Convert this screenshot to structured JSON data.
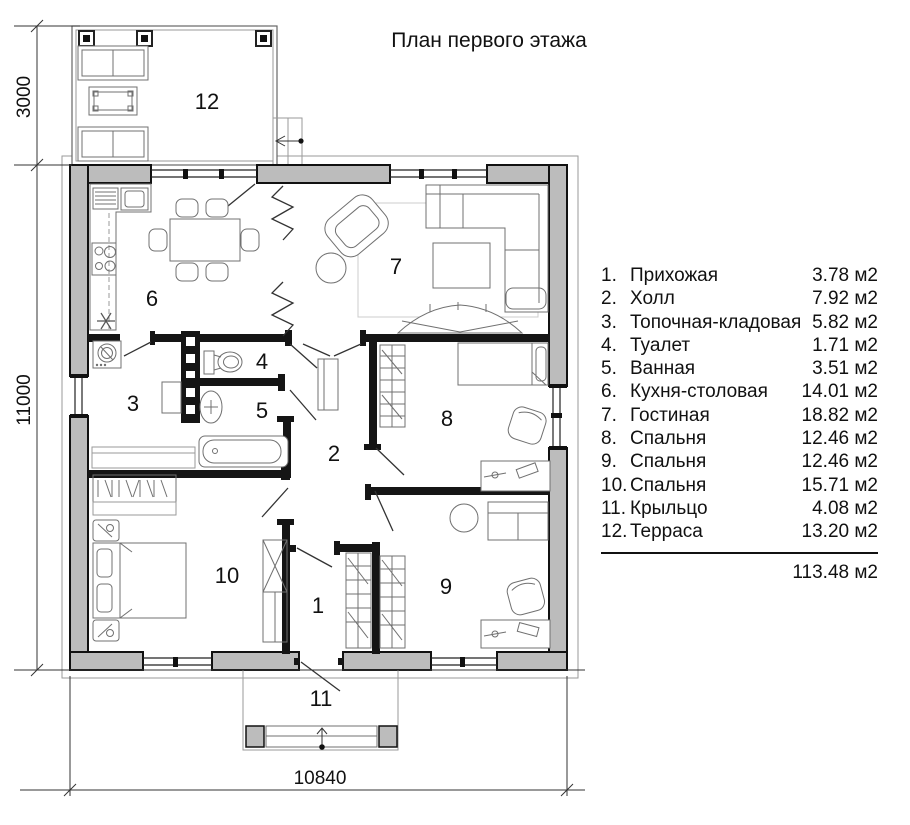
{
  "title": "План первого этажа",
  "dimensions": {
    "terrace_depth": "3000",
    "house_depth": "11000",
    "house_width": "10840"
  },
  "rooms": {
    "r1": "1",
    "r2": "2",
    "r3": "3",
    "r4": "4",
    "r5": "5",
    "r6": "6",
    "r7": "7",
    "r8": "8",
    "r9": "9",
    "r10": "10",
    "r11": "11",
    "r12": "12"
  },
  "legend": {
    "items": [
      {
        "num": "1.",
        "label": "Прихожая",
        "area": "3.78 м2"
      },
      {
        "num": "2.",
        "label": "Холл",
        "area": "7.92 м2"
      },
      {
        "num": "3.",
        "label": "Топочная-кладовая",
        "area": "5.82 м2"
      },
      {
        "num": "4.",
        "label": "Туалет",
        "area": "1.71 м2"
      },
      {
        "num": "5.",
        "label": "Ванная",
        "area": "3.51 м2"
      },
      {
        "num": "6.",
        "label": "Кухня-столовая",
        "area": "14.01 м2"
      },
      {
        "num": "7.",
        "label": "Гостиная",
        "area": "18.82 м2"
      },
      {
        "num": "8.",
        "label": "Спальня",
        "area": "12.46 м2"
      },
      {
        "num": "9.",
        "label": "Спальня",
        "area": "12.46 м2"
      },
      {
        "num": "10.",
        "label": "Спальня",
        "area": "15.71 м2"
      },
      {
        "num": "11.",
        "label": "Крыльцо",
        "area": "4.08 м2"
      },
      {
        "num": "12.",
        "label": "Терраса",
        "area": "13.20 м2"
      }
    ],
    "total": "113.48 м2"
  }
}
